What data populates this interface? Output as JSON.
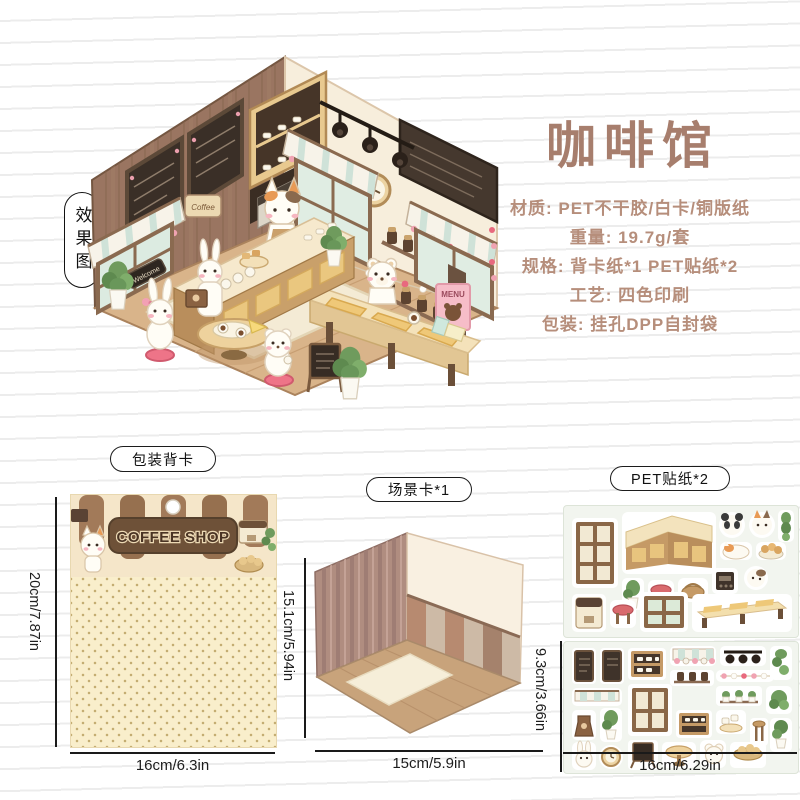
{
  "page": {
    "background": "#ffffff",
    "line_color": "#ececec"
  },
  "effect_label": "效果图",
  "product": {
    "title": "咖啡馆",
    "title_color": "#a77e6d",
    "text_color": "#b68e7b",
    "details": [
      "材质: PET不干胶/白卡/铜版纸",
      "重量: 19.7g/套",
      "规格: 背卡纸*1 PET贴纸*2",
      "工艺: 四色印刷",
      "包装: 挂孔DPP自封袋"
    ]
  },
  "illustration": {
    "coffee_sign": "Coffee",
    "welcome_sign": "Welcome",
    "menu_poster": "MENU"
  },
  "components": {
    "back_card": {
      "label": "包装背卡",
      "logo": "COFFEE SHOP",
      "height_dim": "20cm/7.87in",
      "width_dim": "16cm/6.3in"
    },
    "scene_card": {
      "label": "场景卡*1",
      "height_dim": "15.1cm/5.94in",
      "width_dim": "15cm/5.9in"
    },
    "sticker_sheets": {
      "label": "PET贴纸*2",
      "height_dim": "9.3cm/3.66in",
      "width_dim": "16cm/6.29in"
    }
  }
}
